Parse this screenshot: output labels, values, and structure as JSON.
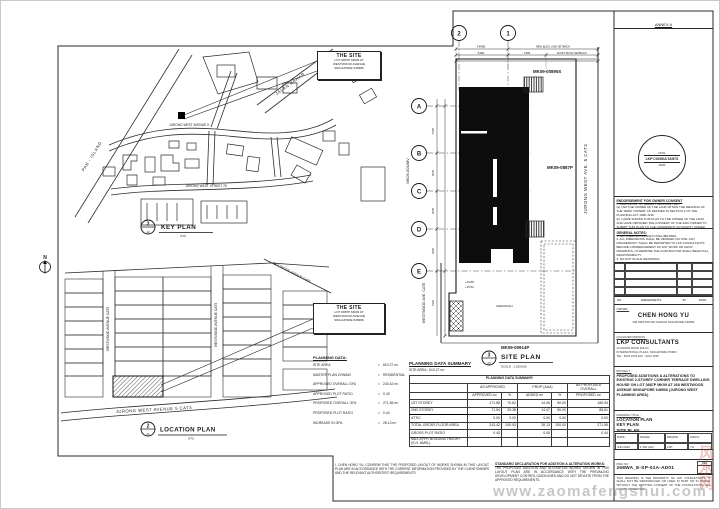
{
  "watermark": {
    "url_text": "www.zaomafengshui.com",
    "cjk_text": "风水网"
  },
  "site_callout": {
    "title": "THE SITE",
    "line1": "LOT 0887P MK09 AT",
    "line2": "WESTWOOD AVENUE",
    "line3": "SINGAPORE 648966"
  },
  "key_plan": {
    "bubble": "2",
    "bubble_sub": "A3",
    "title": "KEY PLAN",
    "scale": "NTS",
    "roads": {
      "pan_island": "PAN - ISLAND",
      "jalan_bahar": "JALAN BAHAR",
      "jurong_west_ave": "JURONG WEST AVENUE 5",
      "jurong_west_st": "JURONG WEST STREET 75"
    }
  },
  "location_plan": {
    "bubble": "2",
    "bubble_sub": "A3",
    "title": "LOCATION PLAN",
    "scale": "NTS",
    "north": "N",
    "roads": {
      "westwood_left": "WESTWOOD AVENUE CAT5",
      "westwood_right": "WESTWOOD AVENUE CAT5",
      "westwood_top": "WESTWOOD AVENUE CAT5",
      "jurong_west": "JURONG WEST AVENUE 5 CAT3"
    }
  },
  "planning_data": {
    "title": "PLANNING DATA:",
    "items": [
      {
        "label": "SITE AREA",
        "sep": "=",
        "value": "610.27 m²"
      },
      {
        "label": "MASTER PLAN ZONING",
        "sep": "=",
        "value": "RESIDENTIAL"
      },
      {
        "label": "APPROVED OVERALL GFA",
        "sep": "=",
        "value": "243.42 m²"
      },
      {
        "label": "APPROVED PLOT RATIO",
        "sep": "=",
        "value": "0.40"
      },
      {
        "label": "PROPOSED OVERALL GFA",
        "sep": "=",
        "value": "271.55 m²"
      },
      {
        "label": "PROPOSED PLOT RATIO",
        "sep": "=",
        "value": "0.44"
      },
      {
        "label": "INCREASE IN GFA",
        "sep": "=",
        "value": "28.13 m²"
      }
    ]
  },
  "site_plan": {
    "bubble": "3",
    "bubble_sub": "A3",
    "title": "SITE PLAN",
    "scale": "SCALE : 1:150(A3)",
    "grid_cols": [
      "2",
      "1"
    ],
    "grid_rows": [
      "A",
      "B",
      "C",
      "D",
      "E"
    ],
    "lot_labels": {
      "top": "MK09-00895X",
      "right": "MK09-0887P",
      "bottom": "MK09-00914P",
      "left": "MK09-00188V"
    },
    "road_labels": {
      "right": "JURONG WEST AVE. 5 CAT3",
      "left": "WESTWOOD AVE. CAT5"
    },
    "dims": {
      "d1": "14985",
      "d2": "5490",
      "d3": "7465",
      "s1": "NEW BLDG LINE SETBACK",
      "s2": "EXIST ROOF SETBACK",
      "v1": "5105",
      "v2": "3035",
      "v3": "3035",
      "v4": "4420",
      "v5": "3120"
    },
    "levels": {
      "l1": "+15.88",
      "l2": "+15.50"
    },
    "veranda": "VERANDAH"
  },
  "summary": {
    "caption": "PLANNING DATA SUMMARY",
    "site_area": "SITE AREA : 610.27 m²",
    "table_title": "PLANNING DATA SUMMARY",
    "group": {
      "g0": "",
      "g1": "AS APPROVED",
      "g2": "PROP (A&A)",
      "g3": "AS PROPOSED OVERALL"
    },
    "head": {
      "h0": "",
      "h1": "APPROVED m²",
      "h2": "%",
      "h3": "ADDED m²",
      "h4": "%",
      "h5": "PROPOSED m²"
    },
    "rows": [
      {
        "label": "1ST STOREY",
        "c1": "171.88",
        "c2": "70.62",
        "c3": "14.06",
        "c4": "50.00",
        "c5": "185.94"
      },
      {
        "label": "2ND STOREY",
        "c1": "71.54",
        "c2": "29.38",
        "c3": "14.07",
        "c4": "50.00",
        "c5": "85.61",
        "hl": true
      },
      {
        "label": "ATTIC",
        "c1": "0.00",
        "c2": "0.00",
        "c3": "0.00",
        "c4": "0.00",
        "c5": "0.00"
      },
      {
        "label": "TOTAL GROSS FLOOR AREA",
        "c1": "243.42",
        "c2": "100.00",
        "c3": "28.13",
        "c4": "100.00",
        "c5": "271.55"
      },
      {
        "label": "GROSS PLOT RATIO",
        "c1": "0.40",
        "c2": "",
        "c3": "0.05",
        "c4": "",
        "c5": "0.44"
      },
      {
        "label": "MAX APPR BUILDING HEIGHT (S.H. AMSL)",
        "c1": "",
        "c2": "",
        "c3": "",
        "c4": "",
        "c5": ""
      }
    ]
  },
  "declarations": {
    "block_a": "I, CHEN HONG YU, CONFIRM THAT THE PROPOSED LAYOUT OF WORKS SHOWN IN THIS LAYOUT PLAN ARE IN ACCORDANCE WITH THE CURRENT INFORMATION PROVIDED BY THE CLIENT/OWNER AND THE RELEVANT AUTHORITIES' REQUIREMENTS.",
    "block_b_title": "STANDARD DECLARATION FOR ADDITION & ALTERATION WORKS:",
    "block_b": "THE PROPOSED ADDITION AND ALTERATION WORKS SHOWN IN THIS LAYOUT PLAN ARE IN ACCORDANCE WITH THE PREVAILING DEVELOPMENT CONTROL GUIDELINES AND DO NOT DEVIATE FROM THE APPROVED REQUIREMENTS."
  },
  "titleblock": {
    "top_label": "ANNEX A",
    "stamp": {
      "line1": "CIVIL",
      "line2": "LKP CONSULTANTS",
      "line3": "2020"
    },
    "endorsement": {
      "title": "ENDORSEMENT FOR OWNER CONSENT",
      "intro": "I, CHEN HONG YU, HEREBY DECLARE THAT:",
      "item_a": "(a) I AM THE OWNER OF THE LAND WITHIN THE MEANING OF THE TERM \"OWNER\" AS DEFINED IN SECTION 2 OF THE PLANNING ACT 1998; AND",
      "item_b": "(b) I HAVE SHOWN THIS PLAN TO THE OWNER OF THE LAND AND HAVE OBTAINED THE CONSENT OF THE SAID OWNER TO SUBMIT THIS PLAN TO THE COMPETENT AUTHORITY UNDER THE PLANNING ACT 1998."
    },
    "general_notes": {
      "title": "GENERAL NOTES:",
      "notes": [
        "1. ALL DIMENSIONS ARE IN MILLIMETRES.",
        "2. ALL DIMENSIONS SHALL BE VERIFIED ON SITE. ANY DISCREPANCY SHALL BE REPORTED TO LKP CONSULTANTS BEFORE COMMENCEMENT OF ANY WORK OR SHOP DRAWINGS, OTHERWISE THE CONTRACTOR SHALL BEAR FULL RESPONSIBILITY.",
        "3. DO NOT SCALE DRAWINGS."
      ]
    },
    "rev_header": {
      "no": "NO.",
      "amendments": "AMENDMENTS",
      "by": "BY",
      "date": "DATE"
    },
    "owner": {
      "caption": "OWNER :",
      "name": "CHEN HONG YU",
      "address": "268 WESTWOOD AVENUE SINGAPORE 648966"
    },
    "consultant": {
      "caption": "QUALIFIED PERSON :",
      "name": "LKP CONSULTANTS",
      "line1": "10 ANSON ROAD #26-04",
      "line2": "INTERNATIONAL PLAZA, SINGAPORE 079903",
      "line3": "TEL : 6223 1533   FAX : 6223 1535"
    },
    "project": {
      "caption": "PROJECT :",
      "text": "PROPOSED ADDITIONS & ALTERATIONS TO EXISTING 2-STOREY CORNER TERRACE DWELLING HOUSE ON LOT 0887P MK09 AT 268 WESTWOOD AVENUE SINGAPORE 648966 (JURONG WEST PLANNING AREA)"
    },
    "drawing": {
      "caption": "DRAWING TITLE :",
      "lines": [
        "LOCATION PLAN",
        "KEY PLAN",
        "SITE PLAN"
      ]
    },
    "meta": {
      "h1": "DATE :",
      "h2": "SCALE :",
      "h3": "DRAWN :",
      "h4": "CHK'D :",
      "v1": "JUN 2020",
      "v2": "1:150 (A3)",
      "v3": "LKP",
      "v4": "YU"
    },
    "job": {
      "label": "JOB REF :",
      "value": "LKP/ 214/553"
    },
    "dwg": {
      "label": "DWG NO :",
      "value": "268WA_E-SP-01A-AD01",
      "rev_label": "REV",
      "rev": "-"
    },
    "note": "THIS DRAWING IS THE PROPERTY OF LKP CONSULTANTS. IT SHALL NOT BE REPRODUCED OR USED IN PART OR IN WHOLE WITHOUT THE WRITTEN CONSENT OF THE CONSULTANTS. ALL RIGHTS RESERVED."
  }
}
